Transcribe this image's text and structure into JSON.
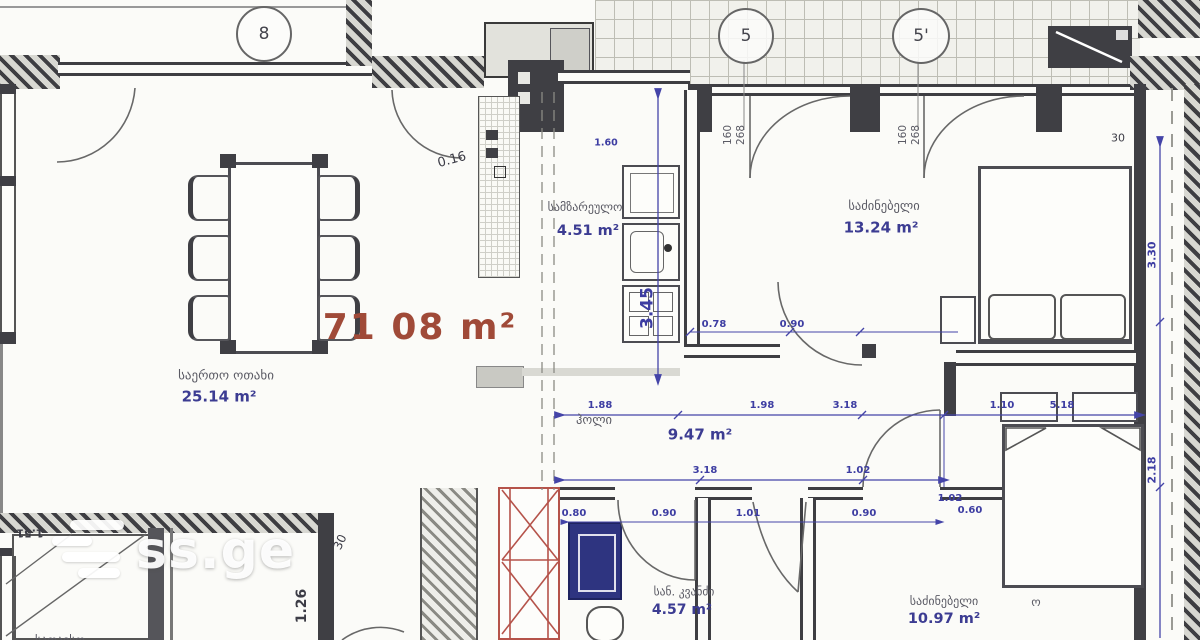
{
  "watermark": {
    "brand": "ss.ge"
  },
  "markers": {
    "balcony8": "8",
    "axis5": "5",
    "axis5prime": "5'"
  },
  "total_area": "71 08 m²",
  "rooms": {
    "living": {
      "name": "საერთო ოთახი",
      "area": "25.14 m²"
    },
    "kitchen": {
      "name": "სამზარეულო",
      "area": "4.51 m²"
    },
    "bedroom1": {
      "name": "საძინებელი",
      "area": "13.24 m²"
    },
    "hall": {
      "name": "ჰოლი",
      "area": "9.47 m²"
    },
    "bathroom": {
      "name": "სან. კვანძი",
      "area": "4.57 m²"
    },
    "bedroom2": {
      "name": "საძინებელი",
      "area": "10.97 m²",
      "suffix": "ო"
    },
    "storage": {
      "name": "სათავსო"
    }
  },
  "door_sizes": {
    "width": "160",
    "height": "268"
  },
  "dims": {
    "k016": "0.16",
    "v_main": "3.45",
    "v_small": "1.60",
    "chain078": "0.78",
    "chain090": "0.90",
    "h1_188": "1.88",
    "h1_198": "1.98",
    "h1_318": "3.18",
    "h1_110": "1.10",
    "h1_518": "5.18",
    "h2_318": "3.18",
    "h2_102": "1.02",
    "cl_102": "1.02",
    "cl_060": "0.60",
    "h3_080": "0.80",
    "h3_090a": "0.90",
    "h3_101": "1.01",
    "h3_090b": "0.90",
    "r_330": "3.30",
    "r_218": "2.18",
    "r_30": "30",
    "l_30": "30",
    "v_126": "1.26",
    "f_151": "1.51"
  }
}
